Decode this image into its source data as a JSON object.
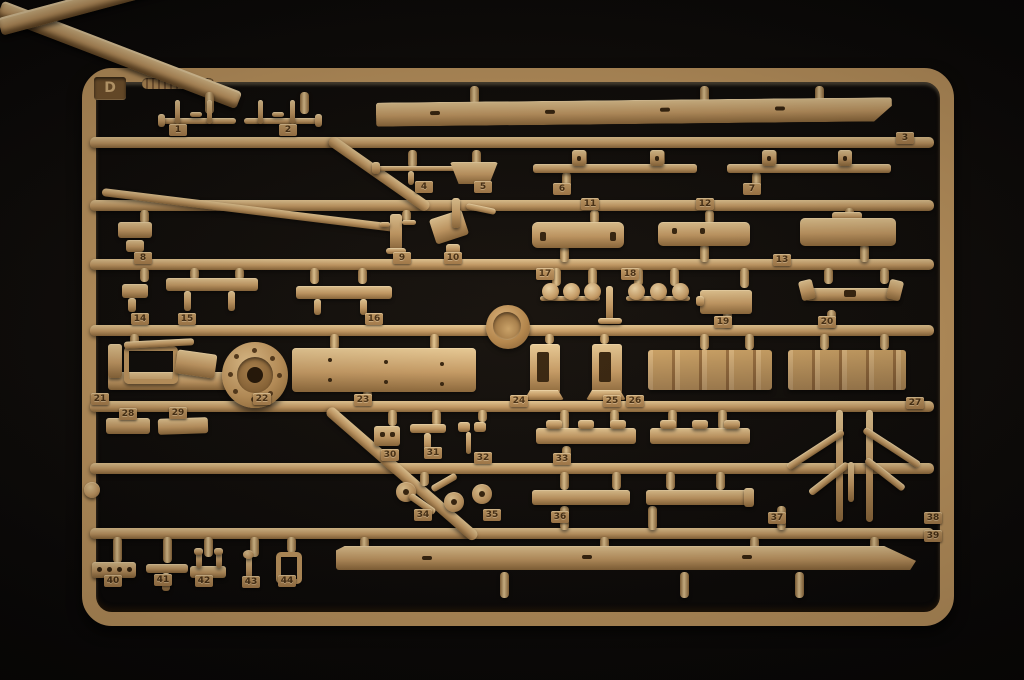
{
  "sprue": {
    "letter": "D",
    "colors": {
      "plastic": "#c89d66",
      "plastic_highlight": "#e9cb96",
      "plastic_shadow": "#8f6a3c",
      "tag": "#b08551",
      "digits": "#4a3115",
      "background": "#0a0807"
    },
    "part_tags": [
      {
        "n": "1",
        "x": 178,
        "y": 130
      },
      {
        "n": "2",
        "x": 288,
        "y": 130
      },
      {
        "n": "3",
        "x": 905,
        "y": 138
      },
      {
        "n": "4",
        "x": 424,
        "y": 187
      },
      {
        "n": "5",
        "x": 483,
        "y": 187
      },
      {
        "n": "6",
        "x": 562,
        "y": 189
      },
      {
        "n": "7",
        "x": 752,
        "y": 189
      },
      {
        "n": "8",
        "x": 143,
        "y": 258
      },
      {
        "n": "9",
        "x": 402,
        "y": 258
      },
      {
        "n": "10",
        "x": 453,
        "y": 258
      },
      {
        "n": "11",
        "x": 590,
        "y": 204
      },
      {
        "n": "12",
        "x": 705,
        "y": 204
      },
      {
        "n": "13",
        "x": 782,
        "y": 260
      },
      {
        "n": "14",
        "x": 140,
        "y": 319
      },
      {
        "n": "15",
        "x": 187,
        "y": 319
      },
      {
        "n": "16",
        "x": 374,
        "y": 319
      },
      {
        "n": "17",
        "x": 545,
        "y": 274
      },
      {
        "n": "18",
        "x": 630,
        "y": 274
      },
      {
        "n": "19",
        "x": 723,
        "y": 322
      },
      {
        "n": "20",
        "x": 827,
        "y": 322
      },
      {
        "n": "21",
        "x": 100,
        "y": 399
      },
      {
        "n": "22",
        "x": 262,
        "y": 399
      },
      {
        "n": "23",
        "x": 363,
        "y": 400
      },
      {
        "n": "24",
        "x": 519,
        "y": 401
      },
      {
        "n": "25",
        "x": 612,
        "y": 401
      },
      {
        "n": "26",
        "x": 635,
        "y": 401
      },
      {
        "n": "27",
        "x": 915,
        "y": 403
      },
      {
        "n": "28",
        "x": 128,
        "y": 414
      },
      {
        "n": "29",
        "x": 178,
        "y": 413
      },
      {
        "n": "30",
        "x": 390,
        "y": 455
      },
      {
        "n": "31",
        "x": 433,
        "y": 453
      },
      {
        "n": "32",
        "x": 483,
        "y": 458
      },
      {
        "n": "33",
        "x": 562,
        "y": 459
      },
      {
        "n": "34",
        "x": 423,
        "y": 515
      },
      {
        "n": "35",
        "x": 492,
        "y": 515
      },
      {
        "n": "36",
        "x": 560,
        "y": 517
      },
      {
        "n": "37",
        "x": 777,
        "y": 518
      },
      {
        "n": "38",
        "x": 933,
        "y": 518
      },
      {
        "n": "39",
        "x": 933,
        "y": 536
      },
      {
        "n": "40",
        "x": 113,
        "y": 581
      },
      {
        "n": "41",
        "x": 163,
        "y": 580
      },
      {
        "n": "42",
        "x": 204,
        "y": 581
      },
      {
        "n": "43",
        "x": 251,
        "y": 582
      },
      {
        "n": "44",
        "x": 287,
        "y": 581
      }
    ]
  }
}
